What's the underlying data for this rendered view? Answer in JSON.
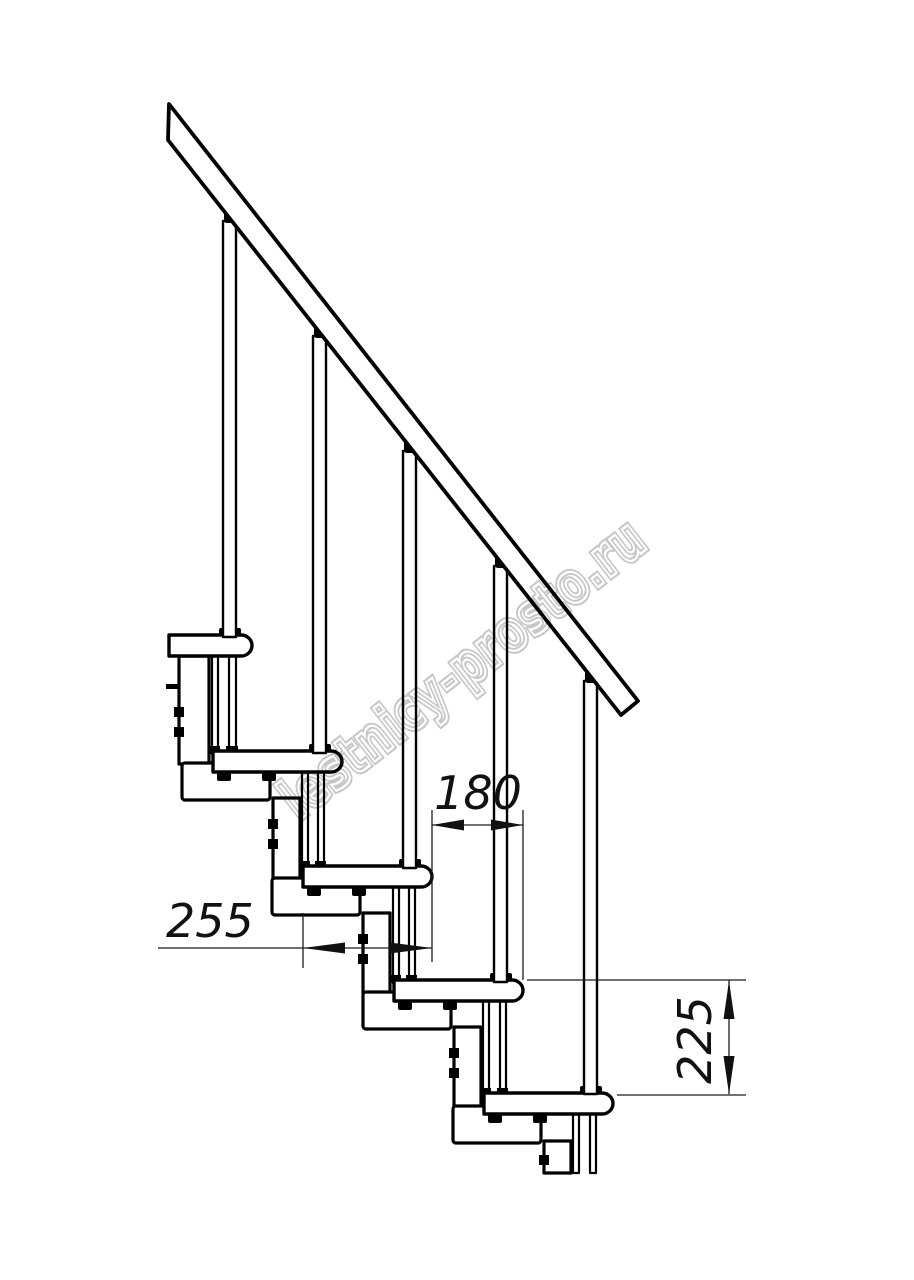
{
  "document": {
    "type": "technical-drawing",
    "subject": "modular staircase side elevation with handrail",
    "background": "#ffffff",
    "ink_color": "#000000",
    "dimension_color": "#1c1c1c"
  },
  "structure": {
    "handrail": "diagonal handrail band, upper-left to lower-right",
    "steps_count": 5,
    "balusters_count": 5,
    "support": "zigzag modular column brackets under each tread"
  },
  "dimensions": {
    "run_between_steps": {
      "value": "180",
      "orientation": "horizontal"
    },
    "tread_depth": {
      "value": "255",
      "orientation": "horizontal"
    },
    "step_rise": {
      "value": "225",
      "orientation": "vertical"
    }
  },
  "watermark": {
    "text": "lestnicy-prosto.ru",
    "color": "#c6c6c6",
    "angle_deg": -38
  }
}
